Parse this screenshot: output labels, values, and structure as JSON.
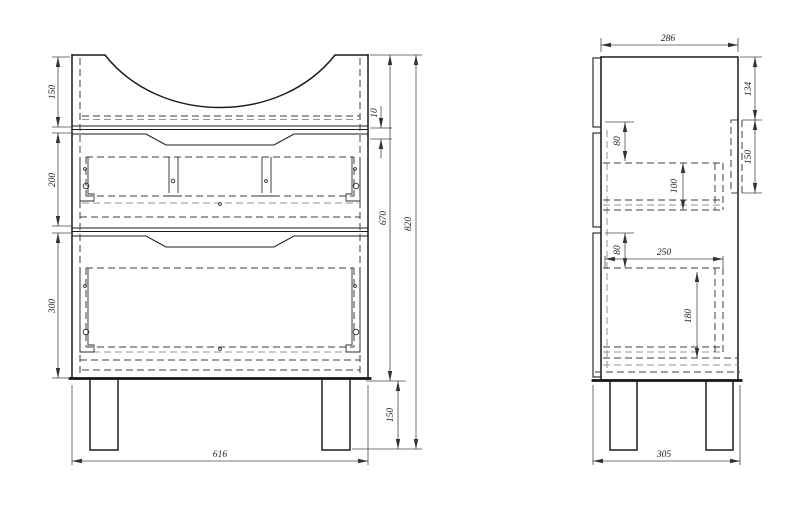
{
  "front": {
    "height_top": "150",
    "height_drawer1": "200",
    "height_drawer2": "300",
    "gap": "10",
    "height_body": "670",
    "height_total": "820",
    "height_legs": "150",
    "width": "616"
  },
  "side": {
    "depth_top": "286",
    "offset_top": "134",
    "panel_height": "150",
    "offset_drawer1": "80",
    "drawer1_box_height": "100",
    "offset_drawer2": "80",
    "drawer_depth": "250",
    "drawer2_box_height": "180",
    "depth_bottom": "305"
  },
  "colors": {
    "line": "#1c1c1c",
    "hidden": "#3d3d3d",
    "hidden_light": "#939393",
    "dimension": "#4a4a4a"
  }
}
